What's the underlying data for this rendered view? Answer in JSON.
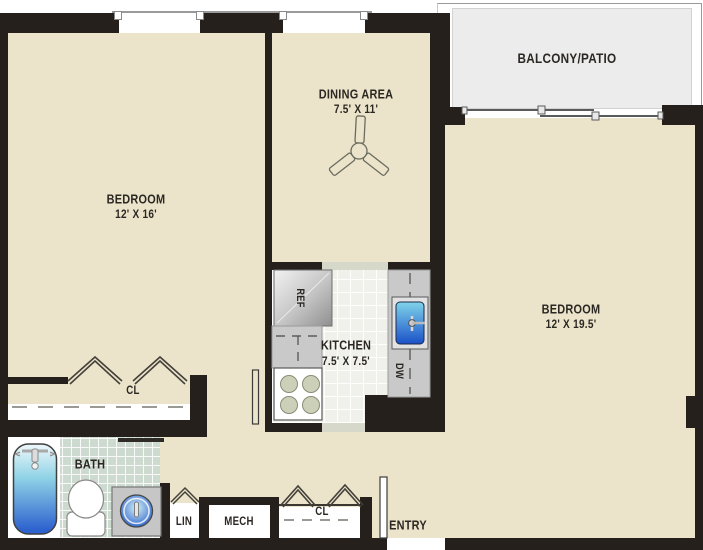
{
  "plan_title": "Two-bedroom apartment floor plan",
  "rooms": {
    "bedroom1": {
      "name": "BEDROOM",
      "dims": "12' X 16'"
    },
    "bedroom2": {
      "name": "BEDROOM",
      "dims": "12' X 19.5'"
    },
    "dining": {
      "name": "DINING AREA",
      "dims": "7.5' X 11'"
    },
    "kitchen": {
      "name": "KITCHEN",
      "dims": "7.5' X 7.5'"
    },
    "balcony": {
      "name": "BALCONY/PATIO"
    },
    "bath": {
      "name": "BATH"
    },
    "entry": {
      "name": "ENTRY"
    },
    "linen": {
      "name": "LIN"
    },
    "mech": {
      "name": "MECH"
    },
    "closet1": {
      "name": "CL"
    },
    "closet2": {
      "name": "CL"
    }
  },
  "appliances": {
    "refrigerator": "REF",
    "dishwasher": "DW"
  },
  "icons": [
    "ceiling-fan-icon",
    "bathtub-icon",
    "toilet-icon",
    "vanity-sink-icon",
    "kitchen-sink-icon",
    "stove-burners-icon",
    "bifold-door-icon",
    "sliding-door-icon",
    "door-leaf-icon",
    "window-icon"
  ],
  "colors": {
    "wall": "#25201b",
    "room_floor": "#ebe4ca",
    "balcony_deck": "#ececec",
    "bath_tile": "#cddacf",
    "kitchen_tile": "#f1f1ec",
    "counter": "#c9c9c9",
    "fixture_blue": "#2e63cf",
    "burner_olive": "#ccd0b8"
  }
}
